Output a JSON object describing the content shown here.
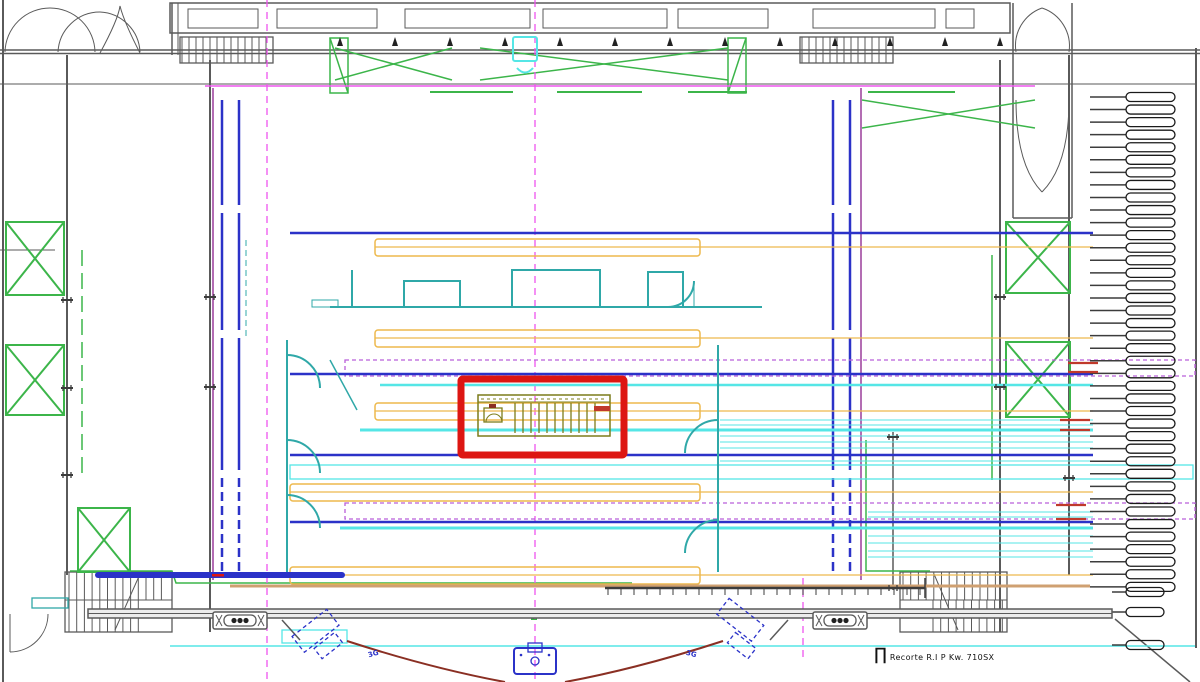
{
  "drawing": {
    "annotation": {
      "symbol": "∏",
      "text": "Recorte R.I P Kw. 710SX"
    },
    "pit": {
      "left_label": "3G",
      "right_label": "3G"
    },
    "rigging_panel": {
      "row_label": "Barra",
      "labeled_rows": [
        1,
        18,
        20,
        28,
        29,
        37
      ],
      "legend": [
        "Tela Mediar",
        "Bambolin",
        "Panos Telones"
      ]
    },
    "fly_lines": {
      "left": [
        [
          "B05",
          "B04"
        ],
        [
          "B03",
          "B02"
        ],
        [
          "B01",
          "B00"
        ],
        [
          "B79",
          "B78"
        ]
      ],
      "right": [
        [
          "B76",
          "B75"
        ],
        [
          "B74",
          "B73"
        ],
        [
          "B72",
          "B71"
        ],
        [
          "B70",
          "B69"
        ]
      ]
    },
    "colors": {
      "wall": "#5a5a5a",
      "green": "#3cb54a",
      "blue": "#2b32c8",
      "cyan": "#55e6e6",
      "teal": "#2fa8a8",
      "magenta": "#ee55ee",
      "violet": "#b95fd9",
      "purple": "#9a3d9a",
      "label_purple": "#7a0f8a",
      "yellow": "#edb94d",
      "orange_dot": "#f2a21d",
      "tan": "#cfa071",
      "red": "#dd1612",
      "stub_red": "#c0392b",
      "olive": "#7c7c1a",
      "darkred": "#8a2f23",
      "capsule_light": "#e4d4ee",
      "capsule_dark": "#2e2440"
    }
  }
}
